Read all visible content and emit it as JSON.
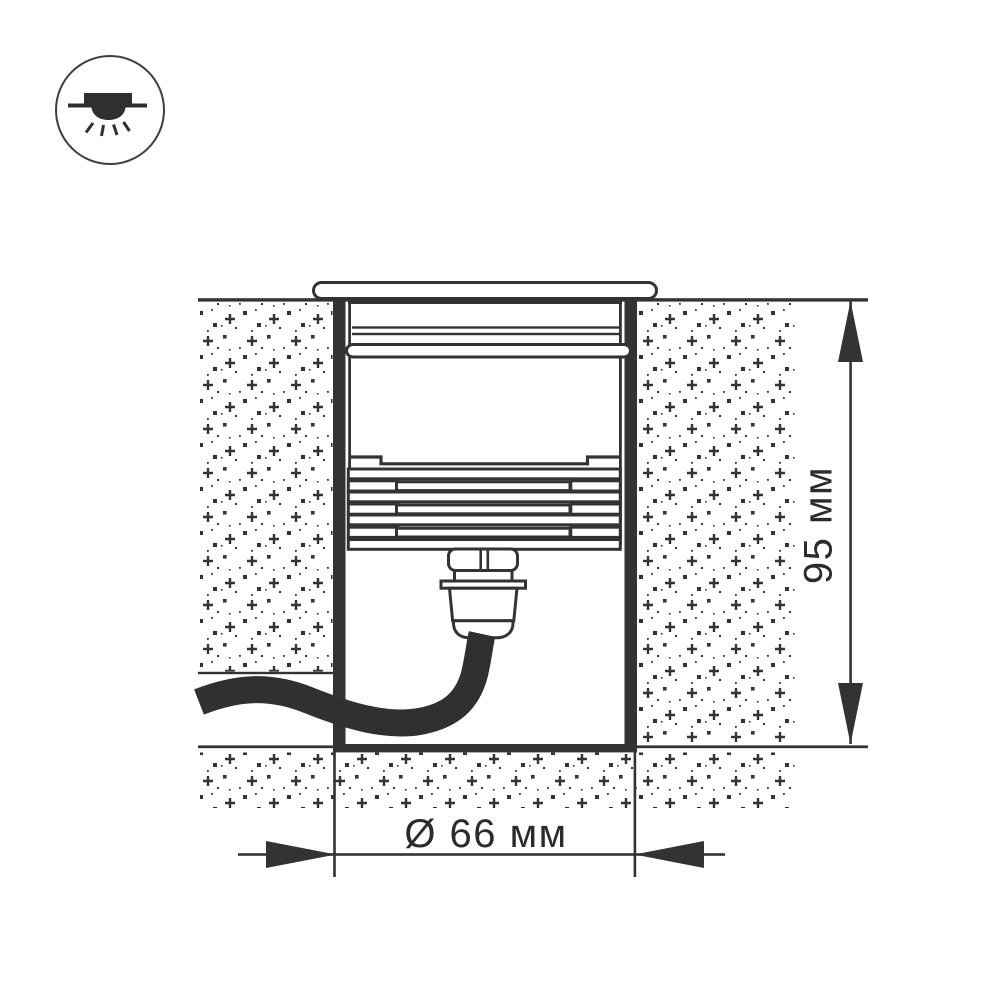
{
  "icon": {
    "name": "recessed-light-icon"
  },
  "diagram": {
    "type": "luminaire installation cross-section",
    "dimensions": {
      "height_label": "95 мм",
      "diameter_label": "Ø 66 мм"
    },
    "colors": {
      "line": "#333333",
      "cable": "#303030",
      "text": "#2b2b2b",
      "background": "#ffffff"
    }
  }
}
